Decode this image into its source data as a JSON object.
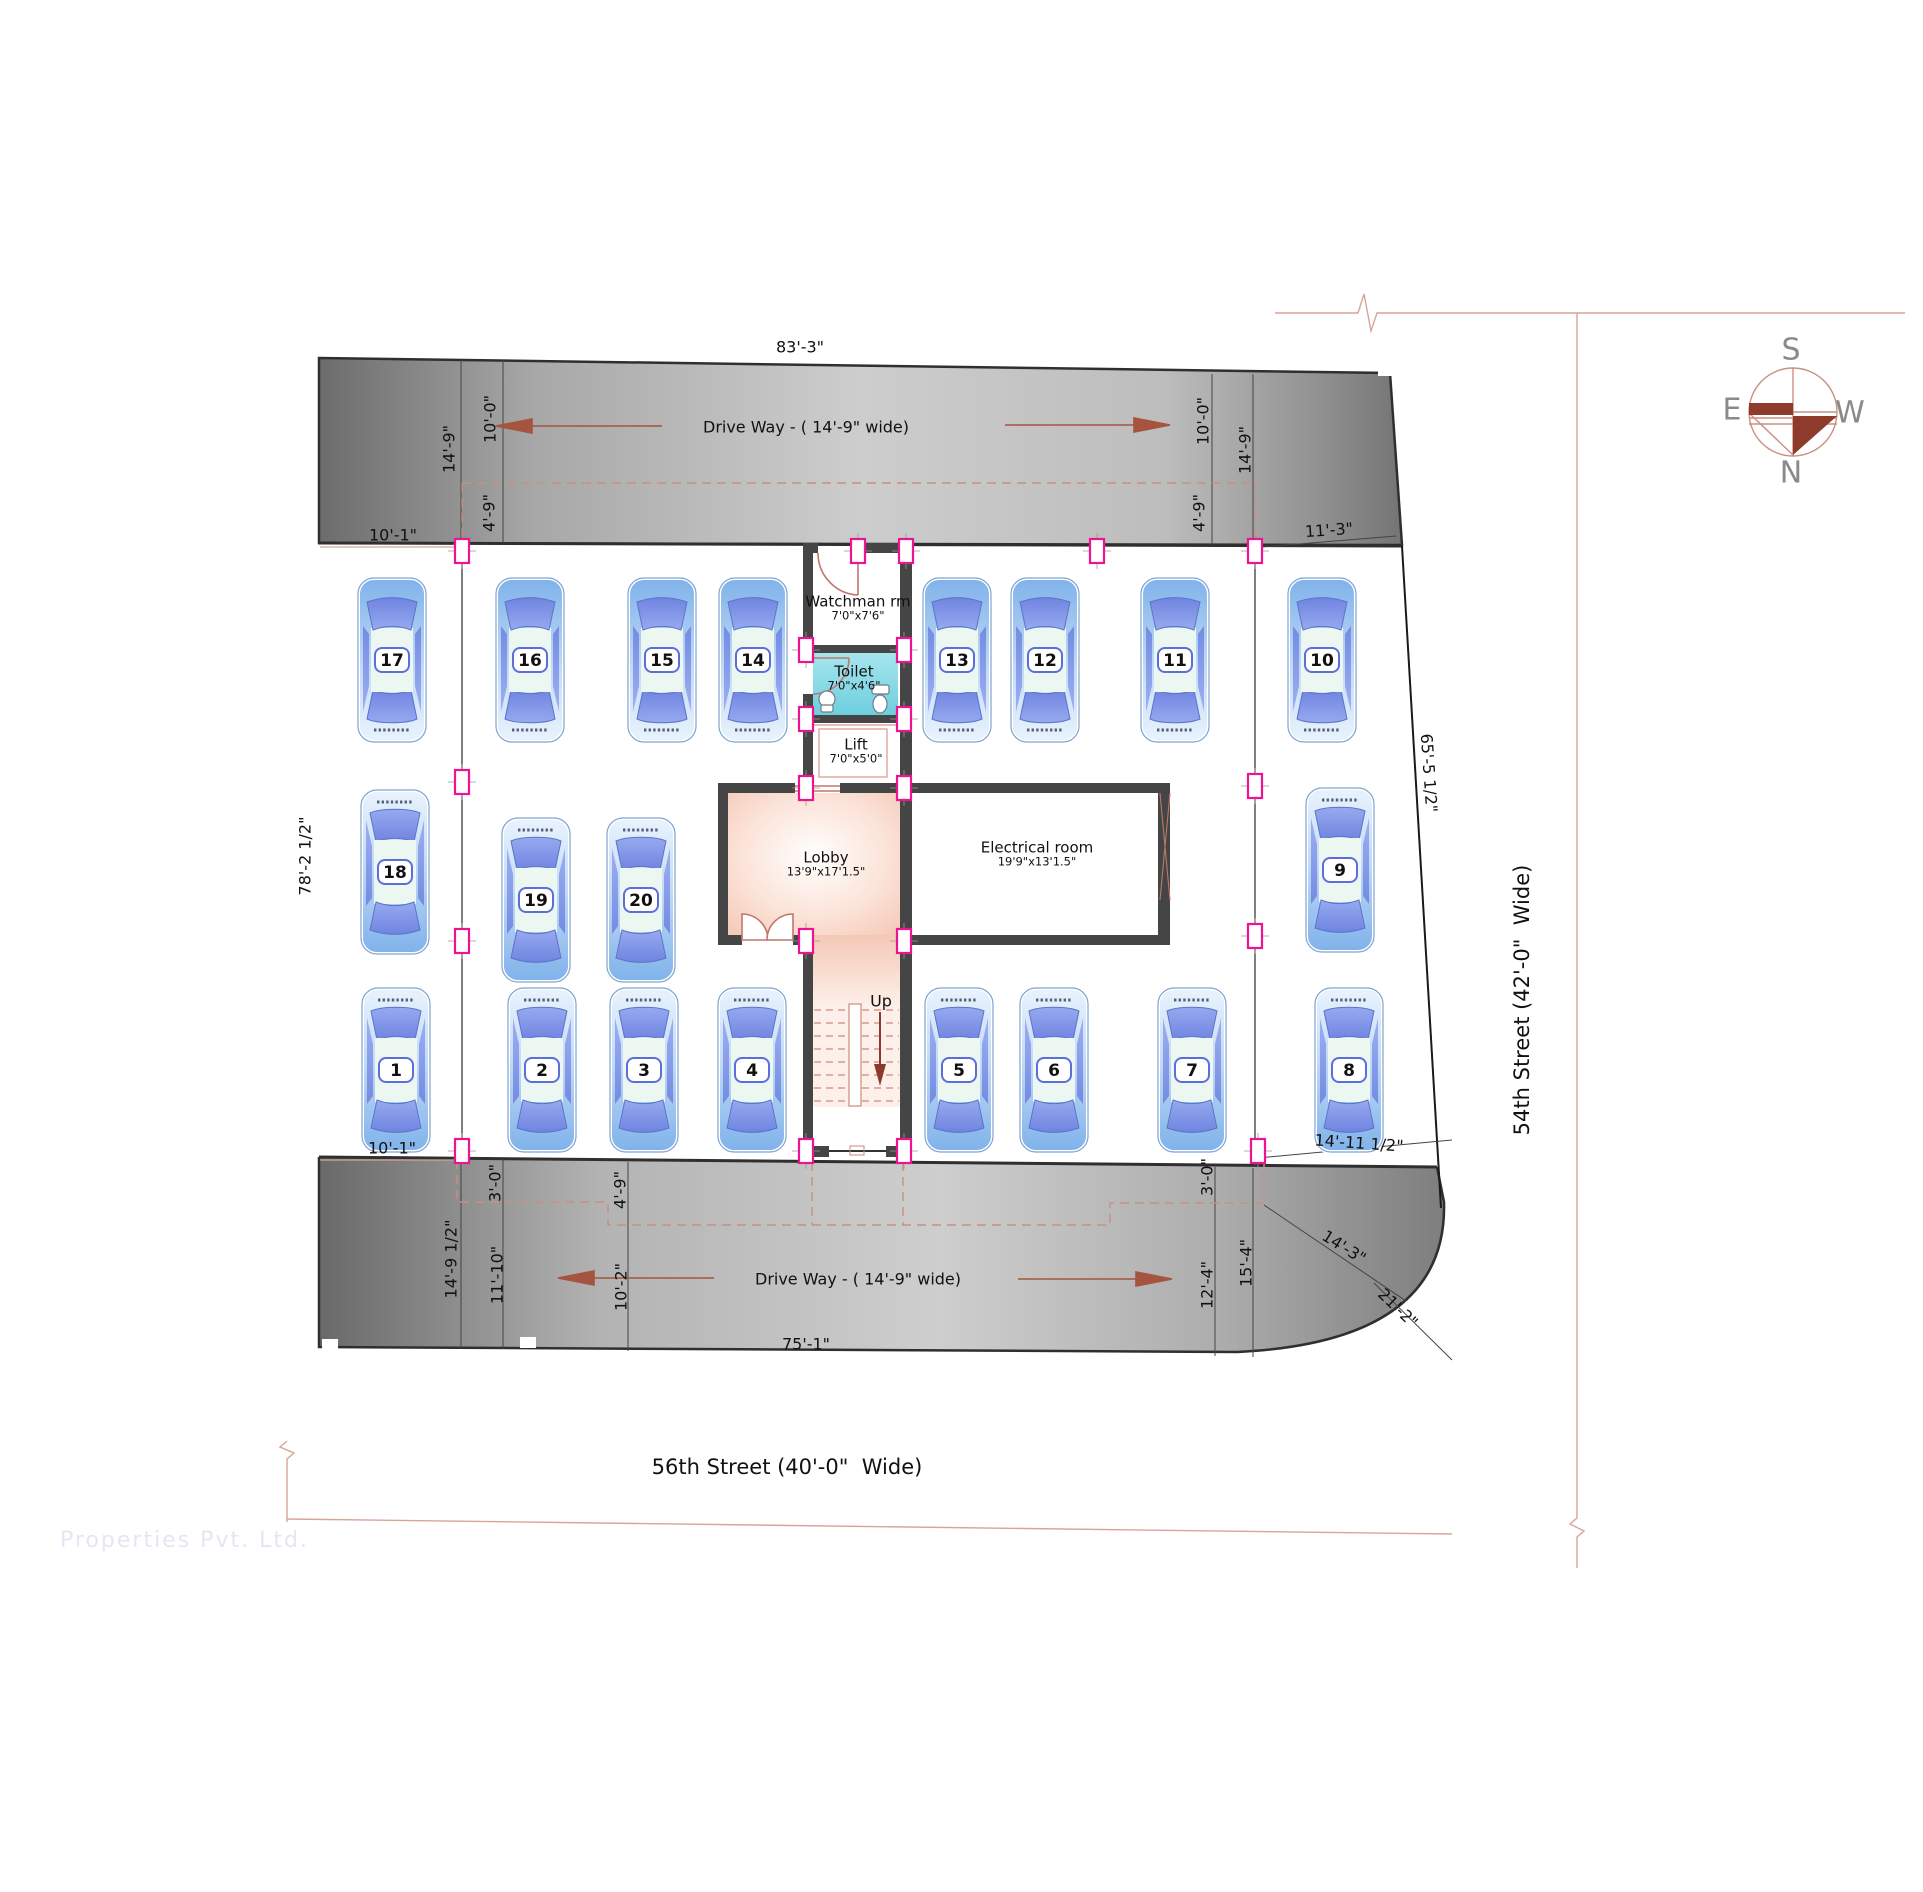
{
  "plan": {
    "type": "parking-floor-plan",
    "streets": {
      "bottom": "56th Street (40'-0\"  Wide)",
      "right": "54th Street (42'-0\"  Wide)"
    },
    "driveways": {
      "top_label": "Drive Way - ( 14'-9\" wide)",
      "bottom_label": "Drive Way - ( 14'-9\" wide)"
    },
    "compass": {
      "n": "N",
      "s": "S",
      "e": "E",
      "w": "W"
    },
    "stairs": {
      "up_label": "Up"
    },
    "watermark": "Properties Pvt. Ltd.",
    "rooms": [
      {
        "name": "Watchman rm",
        "size": "7'0\"x7'6\"",
        "x": 858,
        "y": 608
      },
      {
        "name": "Toilet",
        "size": "7'0\"x4'6\"",
        "x": 854,
        "y": 678
      },
      {
        "name": "Lift",
        "size": "7'0\"x5'0\"",
        "x": 856,
        "y": 751
      },
      {
        "name": "Lobby",
        "size": "13'9\"x17'1.5\"",
        "x": 826,
        "y": 864
      },
      {
        "name": "Electrical room",
        "size": "19'9\"x13'1.5\"",
        "x": 1037,
        "y": 854
      }
    ],
    "parking_spots": [
      {
        "n": "1",
        "x": 396,
        "y": 1070,
        "d": "up"
      },
      {
        "n": "2",
        "x": 542,
        "y": 1070,
        "d": "up"
      },
      {
        "n": "3",
        "x": 644,
        "y": 1070,
        "d": "up"
      },
      {
        "n": "4",
        "x": 752,
        "y": 1070,
        "d": "up"
      },
      {
        "n": "5",
        "x": 959,
        "y": 1070,
        "d": "up"
      },
      {
        "n": "6",
        "x": 1054,
        "y": 1070,
        "d": "up"
      },
      {
        "n": "7",
        "x": 1192,
        "y": 1070,
        "d": "up"
      },
      {
        "n": "8",
        "x": 1349,
        "y": 1070,
        "d": "up"
      },
      {
        "n": "9",
        "x": 1340,
        "y": 870,
        "d": "up"
      },
      {
        "n": "10",
        "x": 1322,
        "y": 660,
        "d": "down"
      },
      {
        "n": "11",
        "x": 1175,
        "y": 660,
        "d": "down"
      },
      {
        "n": "12",
        "x": 1045,
        "y": 660,
        "d": "down"
      },
      {
        "n": "13",
        "x": 957,
        "y": 660,
        "d": "down"
      },
      {
        "n": "14",
        "x": 753,
        "y": 660,
        "d": "down"
      },
      {
        "n": "15",
        "x": 662,
        "y": 660,
        "d": "down"
      },
      {
        "n": "16",
        "x": 530,
        "y": 660,
        "d": "down"
      },
      {
        "n": "17",
        "x": 392,
        "y": 660,
        "d": "down"
      },
      {
        "n": "18",
        "x": 395,
        "y": 872,
        "d": "up"
      },
      {
        "n": "19",
        "x": 536,
        "y": 900,
        "d": "up"
      },
      {
        "n": "20",
        "x": 641,
        "y": 900,
        "d": "up"
      }
    ],
    "dimensions": [
      {
        "t": "83'-3\"",
        "x": 800,
        "y": 347,
        "r": 0
      },
      {
        "t": "14'-9\"",
        "x": 449,
        "y": 449,
        "r": -90
      },
      {
        "t": "10'-0\"",
        "x": 490,
        "y": 419,
        "r": -90
      },
      {
        "t": "4'-9\"",
        "x": 489,
        "y": 513,
        "r": -90
      },
      {
        "t": "10'-1\"",
        "x": 393,
        "y": 535,
        "r": 0
      },
      {
        "t": "10'-0\"",
        "x": 1203,
        "y": 421,
        "r": -90
      },
      {
        "t": "14'-9\"",
        "x": 1245,
        "y": 450,
        "r": -90
      },
      {
        "t": "4'-9\"",
        "x": 1199,
        "y": 513,
        "r": -90
      },
      {
        "t": "11'-3\"",
        "x": 1329,
        "y": 530,
        "r": -4
      },
      {
        "t": "78'-2 1/2\"",
        "x": 305,
        "y": 856,
        "r": -90
      },
      {
        "t": "65'-5 1/2\"",
        "x": 1429,
        "y": 773,
        "r": 86
      },
      {
        "t": "10'-1\"",
        "x": 392,
        "y": 1148,
        "r": 0
      },
      {
        "t": "3'-0\"",
        "x": 495,
        "y": 1183,
        "r": -90
      },
      {
        "t": "4'-9\"",
        "x": 620,
        "y": 1190,
        "r": -90
      },
      {
        "t": "14'-9 1/2\"",
        "x": 451,
        "y": 1259,
        "r": -90
      },
      {
        "t": "11'-10\"",
        "x": 497,
        "y": 1275,
        "r": -90
      },
      {
        "t": "10'-2\"",
        "x": 621,
        "y": 1287,
        "r": -90
      },
      {
        "t": "3'-0\"",
        "x": 1207,
        "y": 1177,
        "r": -90
      },
      {
        "t": "12'-4\"",
        "x": 1207,
        "y": 1285,
        "r": -90
      },
      {
        "t": "15'-4\"",
        "x": 1246,
        "y": 1263,
        "r": -90
      },
      {
        "t": "14'-3\"",
        "x": 1344,
        "y": 1247,
        "r": 32
      },
      {
        "t": "21'-2\"",
        "x": 1398,
        "y": 1308,
        "r": 44
      },
      {
        "t": "14'-11 1/2\"",
        "x": 1359,
        "y": 1143,
        "r": 4
      },
      {
        "t": "75'-1\"",
        "x": 806,
        "y": 1344,
        "r": 0
      }
    ],
    "colors": {
      "wall": "#454545",
      "marker_pink": "#ee1390",
      "salmon_line": "#c98f83",
      "arrow_red": "#a5543f",
      "compass_red": "#8e3b2c",
      "toilet_cyan": "#8fdde8",
      "lobby_salmon": "#f2c3b0",
      "car_body": "#a9c9f0",
      "car_window": "#8299e8",
      "driveway_dark": "#6f6f6f",
      "driveway_light": "#cccccc"
    }
  }
}
